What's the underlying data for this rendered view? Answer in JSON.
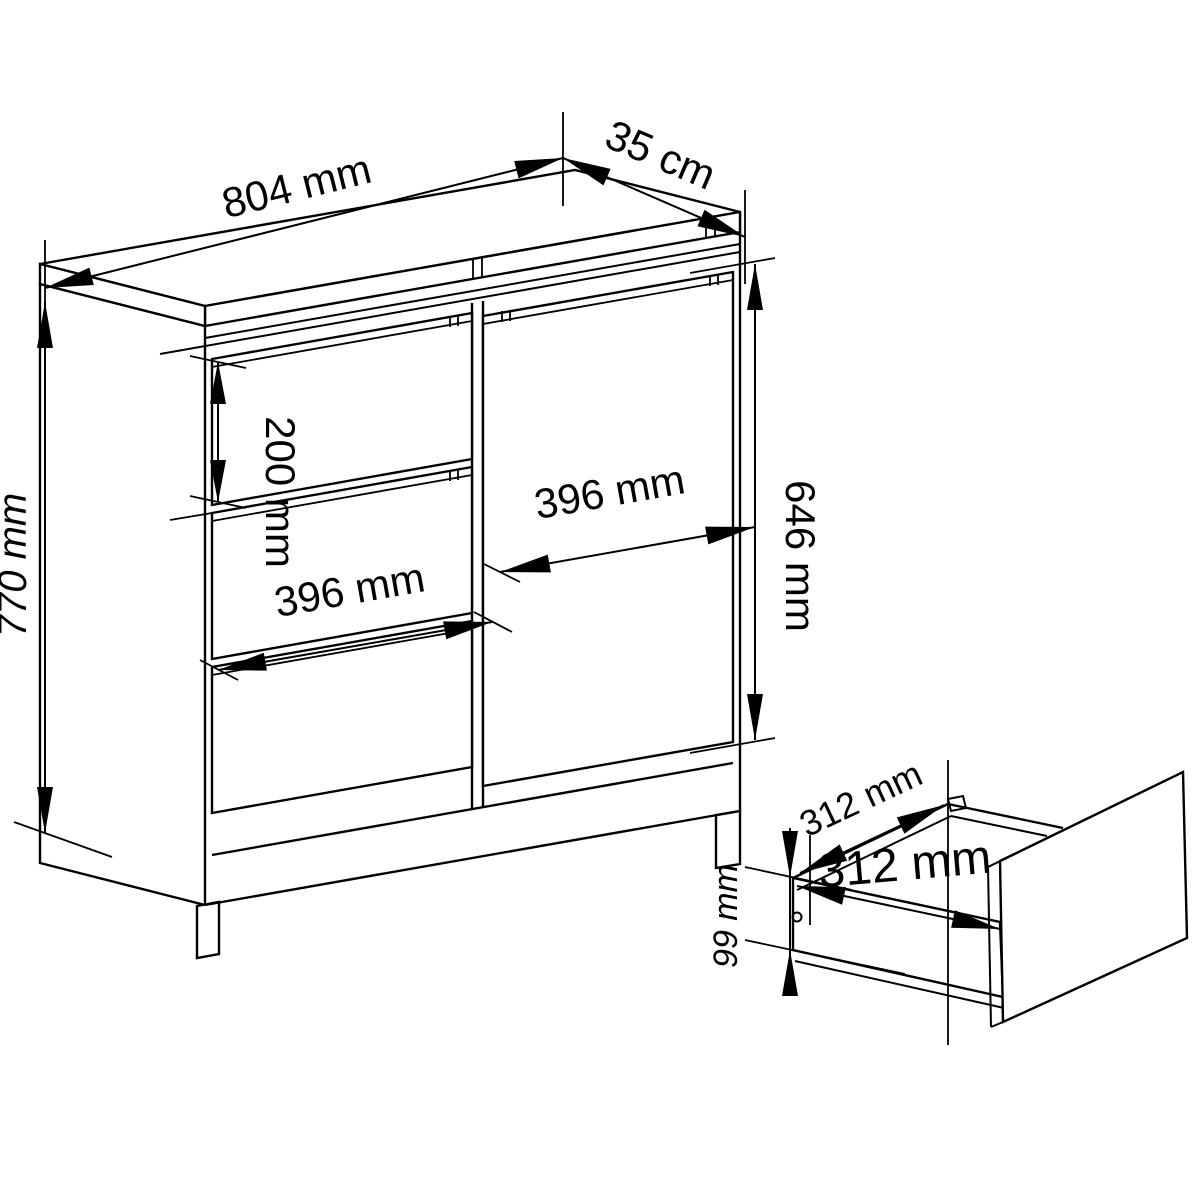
{
  "diagram": {
    "background": "#ffffff",
    "line_color": "#000000",
    "cabinet": {
      "width_label": "804 mm",
      "depth_label": "35 cm",
      "height_label": "770 mm",
      "top_drawer_height_label": "200 mm",
      "drawer_width_label": "396 mm",
      "door_width_label": "396 mm",
      "door_height_label": "646 mm"
    },
    "drawer_detail": {
      "depth_label": "312 mm",
      "width_label": "312 mm",
      "side_height_label": "99 mm"
    }
  }
}
